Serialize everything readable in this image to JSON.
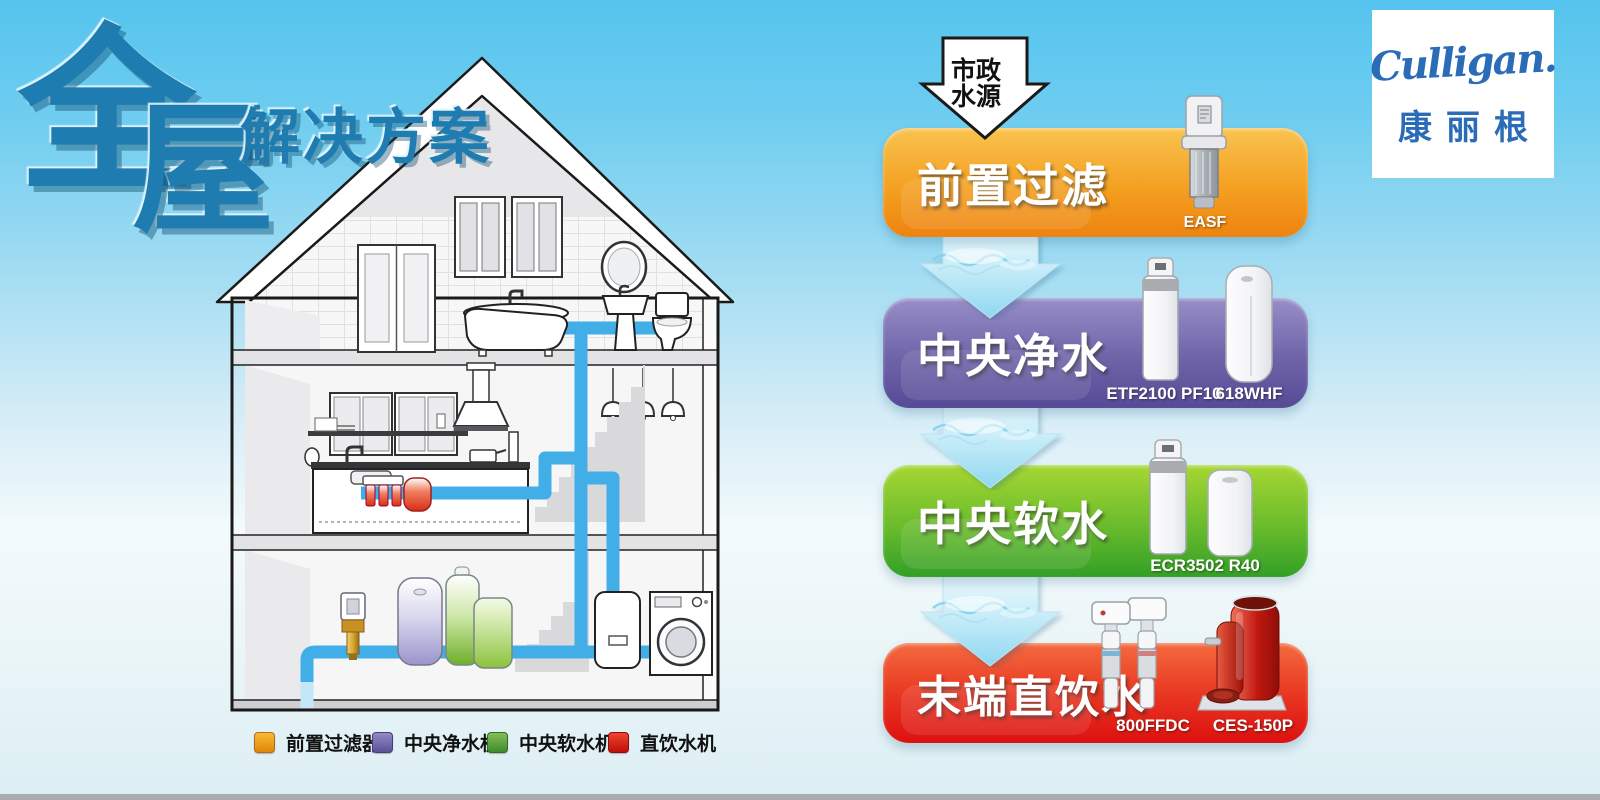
{
  "poster": {
    "title": {
      "char1": "全",
      "char2": "屋",
      "suffix": "解决方案"
    },
    "brand": {
      "name": "Culligan.",
      "name_cn": "康丽根",
      "color": "#2a6cb8"
    },
    "source": {
      "line1": "市政",
      "line2": "水源"
    },
    "flow_steps": [
      {
        "label": "前置过滤",
        "color_top": "#f9c34f",
        "color_bottom": "#ee8310",
        "products": [
          {
            "model": "EASF"
          }
        ]
      },
      {
        "label": "中央净水",
        "color_top": "#988ec8",
        "color_bottom": "#564a96",
        "products": [
          {
            "model": "ETF2100 PF10"
          },
          {
            "model": "618WHF"
          }
        ]
      },
      {
        "label": "中央软水",
        "color_top": "#a6d732",
        "color_bottom": "#339f26",
        "products": [
          {
            "model": "ECR3502 R40"
          }
        ]
      },
      {
        "label": "末端直饮水",
        "color_top": "#f46a3e",
        "color_bottom": "#dc1010",
        "products": [
          {
            "model": "800FFDC"
          },
          {
            "model": "CES-150P"
          }
        ]
      }
    ],
    "legend": [
      {
        "label": "前置过滤器",
        "color": "#efa01e"
      },
      {
        "label": "中央净水机",
        "color": "#7d76b6"
      },
      {
        "label": "中央软水机",
        "color": "#57a441"
      },
      {
        "label": "直饮水机",
        "color": "#da1812"
      }
    ],
    "icons": {
      "source_arrow": "down-arrow-outline",
      "flow_arrow": "water-splash-down-arrow",
      "house": "house-cutaway-illustration",
      "pipe_color": "#41aee8"
    }
  }
}
